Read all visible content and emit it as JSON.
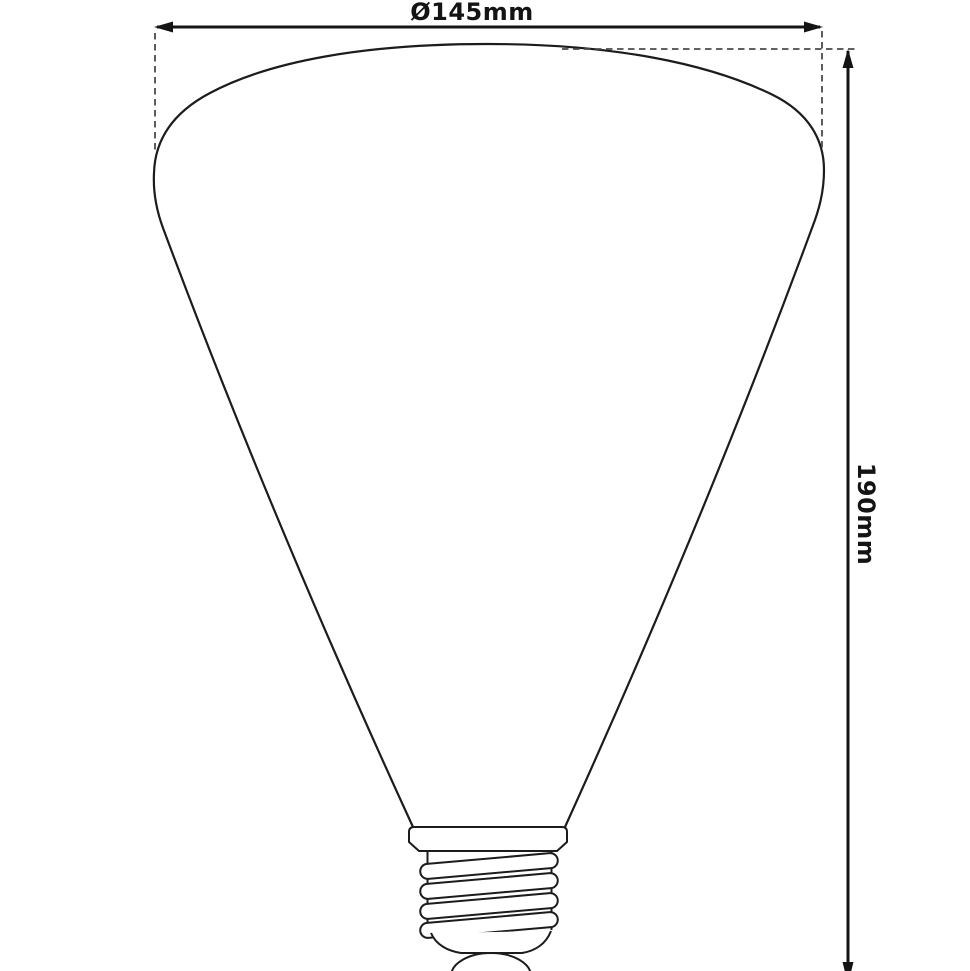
{
  "diagram": {
    "type": "product-dimension-drawing",
    "subject": "cone-shaped light bulb with screw base, line drawing",
    "labels": {
      "diameter": "Ø145mm",
      "height": "190mm"
    },
    "colors": {
      "background": "#ffffff",
      "outline": "#1c1c1c",
      "dimension_line": "#141414",
      "extension_dash": "#4b4b4b",
      "text": "#141414"
    }
  }
}
